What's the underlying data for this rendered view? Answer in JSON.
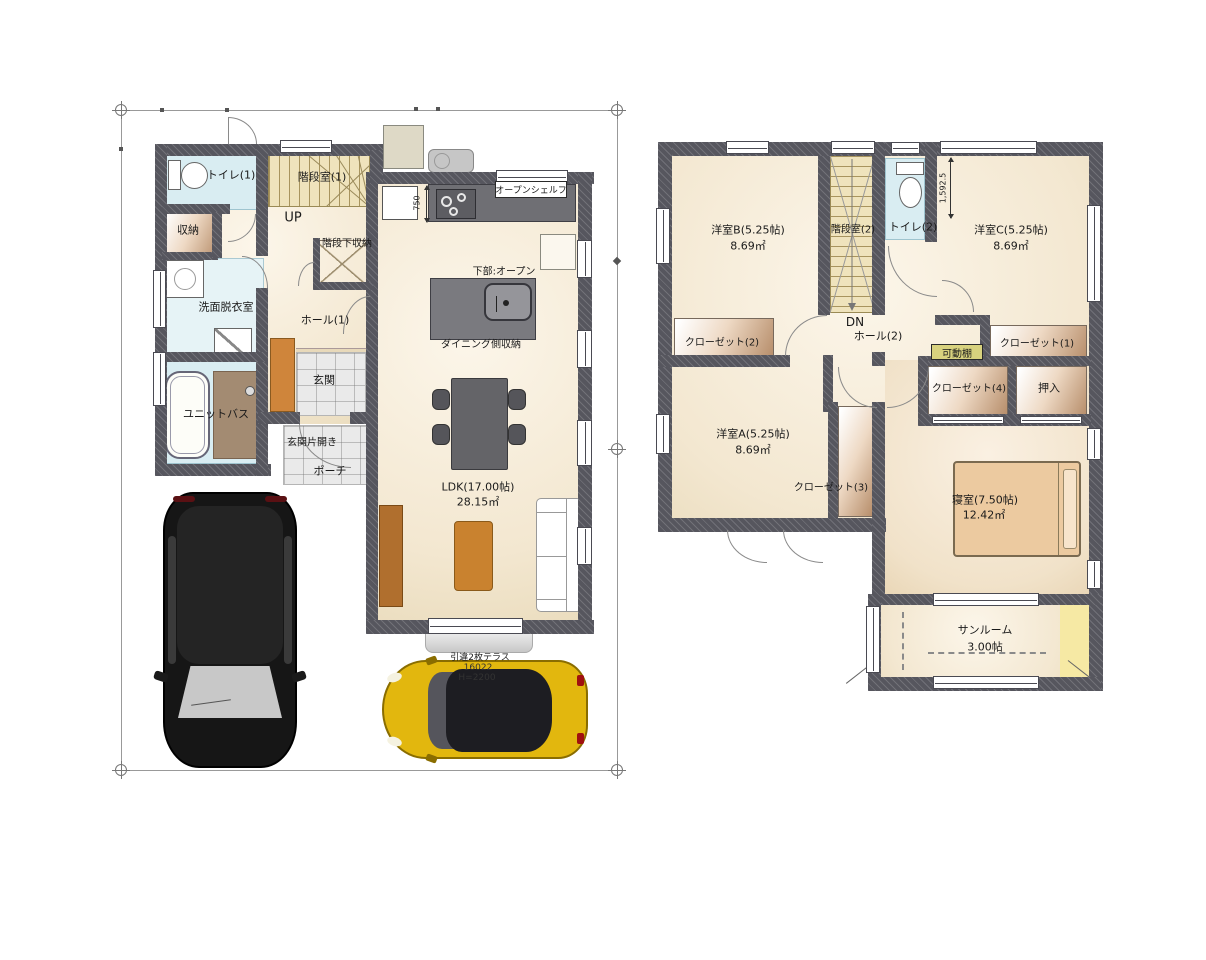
{
  "floor1": {
    "labels": {
      "toilet": "トイレ(1)",
      "stair": "階段室(1)",
      "up": "UP",
      "storage": "収納",
      "under_stair_storage": "階段下収納",
      "washroom": "洗面脱衣室",
      "hall": "ホール(1)",
      "unit_bath": "ユニットバス",
      "entrance": "玄関",
      "entrance_door": "玄関片開き",
      "porch": "ポーチ",
      "open_shelf": "オープンシェルフ",
      "under_open": "下部:オープン",
      "dining_storage": "ダイニング側収納",
      "ldk_name": "LDK(17.00帖)",
      "ldk_area": "28.15㎡",
      "terrace_door": "引違2枚テラス",
      "terrace_size": "16022",
      "terrace_height": "H=2200",
      "dim_750": "750"
    }
  },
  "floor2": {
    "labels": {
      "room_b_name": "洋室B(5.25帖)",
      "room_b_area": "8.69㎡",
      "stair": "階段室(2)",
      "toilet": "トイレ(2)",
      "dim_toilet": "1,592.5",
      "room_c_name": "洋室C(5.25帖)",
      "room_c_area": "8.69㎡",
      "closet2": "クローゼット(2)",
      "dn": "DN",
      "hall": "ホール(2)",
      "movable_shelf": "可動棚",
      "closet1": "クローゼット(1)",
      "closet4": "クローゼット(4)",
      "oshiire": "押入",
      "room_a_name": "洋室A(5.25帖)",
      "room_a_area": "8.69㎡",
      "closet3": "クローゼット(3)",
      "master_name": "寝室(7.50帖)",
      "master_area": "12.42㎡",
      "sunroom_name": "サンルーム",
      "sunroom_area": "3.00帖"
    }
  },
  "colors": {
    "wall": "#56565e",
    "floor_cream": "#f3e7d0",
    "water_cyan": "#d9edf2",
    "stair_beige": "#efe3bc",
    "closet_tan": "#b78e6b",
    "wood_accent": "#c9822f",
    "counter_gray": "#6f6f74",
    "sunroom_yellow": "#f6e9a4",
    "car_yellow": "#e2b70e",
    "car_black": "#161616"
  }
}
